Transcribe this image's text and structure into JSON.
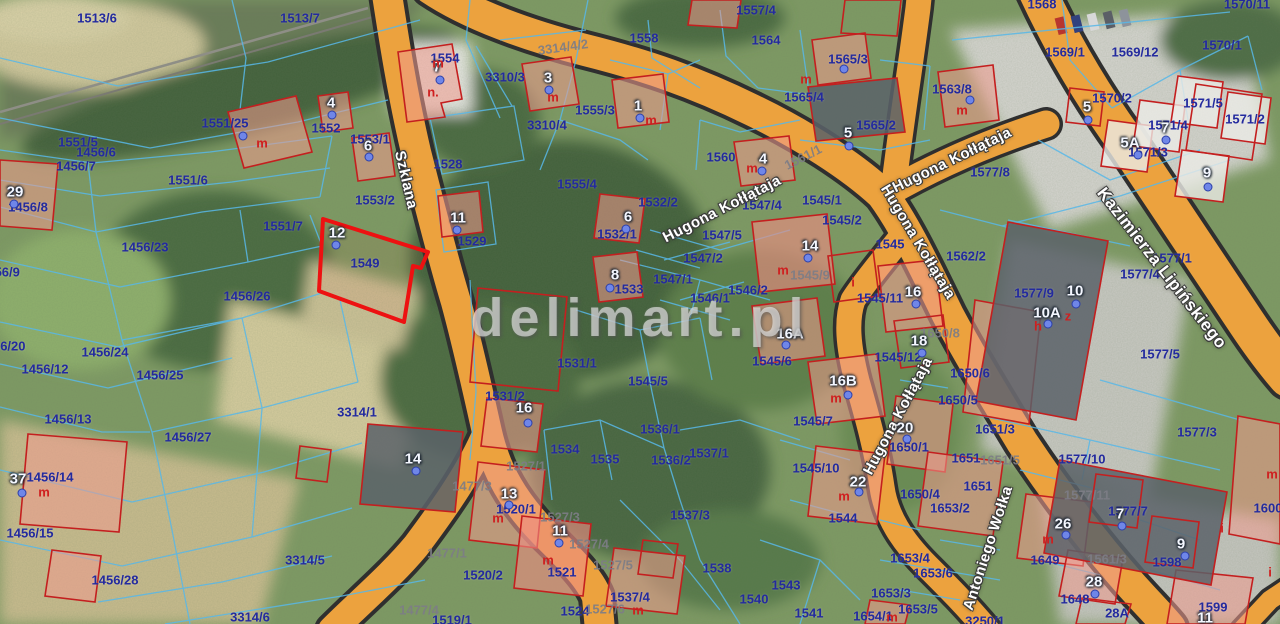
{
  "map": {
    "watermark": "delimart.pl",
    "highlighted_parcel": "1549",
    "accent_colors": {
      "road": "#eca23e",
      "parcel_line": "#58b8e8",
      "building": "#c41f1f",
      "highlight": "#ed1111",
      "label": "#232a9e"
    },
    "streets": [
      {
        "name": "Szklana",
        "x": 406,
        "y": 180,
        "rot": 77,
        "size": 15
      },
      {
        "name": "Hugona Kołłątaja",
        "x": 722,
        "y": 209,
        "rot": -27,
        "size": 15
      },
      {
        "name": "Hugona Kołłątaja",
        "x": 952,
        "y": 160,
        "rot": -26,
        "size": 15
      },
      {
        "name": "Hugona Kołłątaja",
        "x": 918,
        "y": 242,
        "rot": 59,
        "size": 15
      },
      {
        "name": "Hugona Kołłątaja",
        "x": 898,
        "y": 416,
        "rot": -62,
        "size": 15
      },
      {
        "name": "Antoniego Wołka",
        "x": 988,
        "y": 548,
        "rot": -72,
        "size": 15
      },
      {
        "name": "Kazimierza Lipińskiego",
        "x": 1162,
        "y": 268,
        "rot": 52,
        "size": 17
      }
    ],
    "parcel_labels": [
      {
        "t": "1513/6",
        "x": 97,
        "y": 18
      },
      {
        "t": "1513/7",
        "x": 300,
        "y": 18
      },
      {
        "t": "1551/25",
        "x": 225,
        "y": 123
      },
      {
        "t": "1551/5",
        "x": 78,
        "y": 142
      },
      {
        "t": "1456/6",
        "x": 96,
        "y": 152
      },
      {
        "t": "1456/7",
        "x": 76,
        "y": 166
      },
      {
        "t": "1551/6",
        "x": 188,
        "y": 180
      },
      {
        "t": "29",
        "x": 15,
        "y": 192
      },
      {
        "t": "1456/8",
        "x": 28,
        "y": 207
      },
      {
        "t": "1551/7",
        "x": 283,
        "y": 226
      },
      {
        "t": "1456/23",
        "x": 145,
        "y": 247
      },
      {
        "t": "1456/9",
        "x": 0,
        "y": 272
      },
      {
        "t": "1456/26",
        "x": 247,
        "y": 296
      },
      {
        "t": "1456/20",
        "x": 2,
        "y": 346
      },
      {
        "t": "1456/24",
        "x": 105,
        "y": 352
      },
      {
        "t": "1456/12",
        "x": 45,
        "y": 369
      },
      {
        "t": "1456/25",
        "x": 160,
        "y": 375
      },
      {
        "t": "1456/13",
        "x": 68,
        "y": 419
      },
      {
        "t": "1456/27",
        "x": 188,
        "y": 437
      },
      {
        "t": "1456/14",
        "x": 50,
        "y": 477
      },
      {
        "t": "1456/15",
        "x": 30,
        "y": 533
      },
      {
        "t": "1456/28",
        "x": 115,
        "y": 580
      },
      {
        "t": "3314/5",
        "x": 305,
        "y": 560
      },
      {
        "t": "3314/6",
        "x": 250,
        "y": 617
      },
      {
        "t": "3314/1",
        "x": 357,
        "y": 412
      },
      {
        "t": "1549",
        "x": 365,
        "y": 263
      },
      {
        "t": "1553/2",
        "x": 375,
        "y": 200
      },
      {
        "t": "1553/1",
        "x": 370,
        "y": 139
      },
      {
        "t": "1552",
        "x": 326,
        "y": 128
      },
      {
        "t": "1554",
        "x": 445,
        "y": 58
      },
      {
        "t": "1528",
        "x": 448,
        "y": 164
      },
      {
        "t": "1529",
        "x": 472,
        "y": 241
      },
      {
        "t": "3310/3",
        "x": 505,
        "y": 77
      },
      {
        "t": "3310/4",
        "x": 547,
        "y": 125
      },
      {
        "t": "1555/3",
        "x": 595,
        "y": 110
      },
      {
        "t": "1555/4",
        "x": 577,
        "y": 184
      },
      {
        "t": "1558",
        "x": 644,
        "y": 38
      },
      {
        "t": "1557/4",
        "x": 756,
        "y": 10
      },
      {
        "t": "1564",
        "x": 766,
        "y": 40
      },
      {
        "t": "1560",
        "x": 721,
        "y": 157
      },
      {
        "t": "1565/3",
        "x": 848,
        "y": 59
      },
      {
        "t": "1565/4",
        "x": 804,
        "y": 97
      },
      {
        "t": "1565/2",
        "x": 876,
        "y": 125
      },
      {
        "t": "1563/8",
        "x": 952,
        "y": 89
      },
      {
        "t": "1569/1",
        "x": 1065,
        "y": 52
      },
      {
        "t": "1569/12",
        "x": 1135,
        "y": 52
      },
      {
        "t": "1570/1",
        "x": 1222,
        "y": 45
      },
      {
        "t": "1570/2",
        "x": 1112,
        "y": 98
      },
      {
        "t": "1571/5",
        "x": 1203,
        "y": 103
      },
      {
        "t": "1571/2",
        "x": 1245,
        "y": 119
      },
      {
        "t": "1571/4",
        "x": 1168,
        "y": 125
      },
      {
        "t": "1571/3",
        "x": 1148,
        "y": 152
      },
      {
        "t": "1568",
        "x": 1042,
        "y": 4
      },
      {
        "t": "1570/11",
        "x": 1247,
        "y": 4
      },
      {
        "t": "1577/8",
        "x": 990,
        "y": 172
      },
      {
        "t": "1562/2",
        "x": 966,
        "y": 256
      },
      {
        "t": "1577/4",
        "x": 1140,
        "y": 274
      },
      {
        "t": "1577/1",
        "x": 1172,
        "y": 258
      },
      {
        "t": "1577/9",
        "x": 1034,
        "y": 293
      },
      {
        "t": "1577/5",
        "x": 1160,
        "y": 354
      },
      {
        "t": "1532/2",
        "x": 658,
        "y": 202
      },
      {
        "t": "1532/1",
        "x": 617,
        "y": 234
      },
      {
        "t": "1533",
        "x": 629,
        "y": 289
      },
      {
        "t": "1531/1",
        "x": 577,
        "y": 363
      },
      {
        "t": "1531/2",
        "x": 505,
        "y": 396
      },
      {
        "t": "1534",
        "x": 565,
        "y": 449
      },
      {
        "t": "1535",
        "x": 605,
        "y": 459
      },
      {
        "t": "1536/1",
        "x": 660,
        "y": 429
      },
      {
        "t": "1536/2",
        "x": 671,
        "y": 460
      },
      {
        "t": "1537/1",
        "x": 709,
        "y": 453
      },
      {
        "t": "1537/3",
        "x": 690,
        "y": 515
      },
      {
        "t": "1538",
        "x": 717,
        "y": 568
      },
      {
        "t": "1543",
        "x": 786,
        "y": 585
      },
      {
        "t": "1540",
        "x": 754,
        "y": 599
      },
      {
        "t": "1541",
        "x": 809,
        "y": 613
      },
      {
        "t": "1545/7",
        "x": 813,
        "y": 421
      },
      {
        "t": "1545/10",
        "x": 816,
        "y": 468
      },
      {
        "t": "1544",
        "x": 843,
        "y": 518
      },
      {
        "t": "1545/5",
        "x": 648,
        "y": 381
      },
      {
        "t": "1545/6",
        "x": 772,
        "y": 361
      },
      {
        "t": "1545/11",
        "x": 880,
        "y": 298
      },
      {
        "t": "1545/12",
        "x": 898,
        "y": 357
      },
      {
        "t": "1545/1",
        "x": 822,
        "y": 200
      },
      {
        "t": "1545/2",
        "x": 842,
        "y": 220
      },
      {
        "t": "1545",
        "x": 890,
        "y": 244
      },
      {
        "t": "1546/2",
        "x": 748,
        "y": 290
      },
      {
        "t": "1546/1",
        "x": 710,
        "y": 298
      },
      {
        "t": "1547/4",
        "x": 762,
        "y": 205
      },
      {
        "t": "1547/5",
        "x": 722,
        "y": 235
      },
      {
        "t": "1547/2",
        "x": 703,
        "y": 258
      },
      {
        "t": "1547/1",
        "x": 673,
        "y": 279
      },
      {
        "t": "1520/1",
        "x": 516,
        "y": 509
      },
      {
        "t": "1520/2",
        "x": 483,
        "y": 575
      },
      {
        "t": "1521",
        "x": 562,
        "y": 572
      },
      {
        "t": "1524",
        "x": 575,
        "y": 611
      },
      {
        "t": "1537/4",
        "x": 630,
        "y": 597
      },
      {
        "t": "1519/1",
        "x": 452,
        "y": 620
      },
      {
        "t": "1650/1",
        "x": 909,
        "y": 447
      },
      {
        "t": "1650/4",
        "x": 920,
        "y": 494
      },
      {
        "t": "1653/4",
        "x": 910,
        "y": 558
      },
      {
        "t": "1653/6",
        "x": 933,
        "y": 573
      },
      {
        "t": "1653/3",
        "x": 891,
        "y": 593
      },
      {
        "t": "1653/5",
        "x": 918,
        "y": 609
      },
      {
        "t": "1654/1",
        "x": 873,
        "y": 616
      },
      {
        "t": "1653/2",
        "x": 950,
        "y": 508
      },
      {
        "t": "1651/3",
        "x": 995,
        "y": 429
      },
      {
        "t": "1651",
        "x": 966,
        "y": 458
      },
      {
        "t": "1651",
        "x": 978,
        "y": 486
      },
      {
        "t": "1650/6",
        "x": 970,
        "y": 373
      },
      {
        "t": "1650/5",
        "x": 958,
        "y": 400
      },
      {
        "t": "1577/10",
        "x": 1082,
        "y": 459
      },
      {
        "t": "1577/3",
        "x": 1197,
        "y": 432
      },
      {
        "t": "1577/7",
        "x": 1128,
        "y": 511
      },
      {
        "t": "1649",
        "x": 1045,
        "y": 560
      },
      {
        "t": "1598",
        "x": 1167,
        "y": 562
      },
      {
        "t": "1648",
        "x": 1075,
        "y": 599
      },
      {
        "t": "28A",
        "x": 1117,
        "y": 613
      },
      {
        "t": "1599",
        "x": 1213,
        "y": 607
      },
      {
        "t": "1600",
        "x": 1268,
        "y": 508
      },
      {
        "t": "3250/1",
        "x": 985,
        "y": 621
      }
    ],
    "road_parcel_labels": [
      {
        "t": "3314/4/2",
        "x": 563,
        "y": 47,
        "rot": -8
      },
      {
        "t": "1561/1",
        "x": 803,
        "y": 157,
        "rot": -27
      },
      {
        "t": "1477/3",
        "x": 472,
        "y": 486,
        "rot": 0
      },
      {
        "t": "1477/1",
        "x": 447,
        "y": 553,
        "rot": 0
      },
      {
        "t": "1477/4",
        "x": 419,
        "y": 610,
        "rot": 0
      },
      {
        "t": "1527/1",
        "x": 526,
        "y": 466,
        "rot": 0
      },
      {
        "t": "1527/3",
        "x": 560,
        "y": 517,
        "rot": 0
      },
      {
        "t": "1527/4",
        "x": 589,
        "y": 544,
        "rot": 0
      },
      {
        "t": "1527/5",
        "x": 613,
        "y": 565,
        "rot": 0
      },
      {
        "t": "1527/6",
        "x": 605,
        "y": 609,
        "rot": 0
      },
      {
        "t": "1545/9",
        "x": 810,
        "y": 275,
        "rot": 0
      },
      {
        "t": "1650/8",
        "x": 940,
        "y": 333,
        "rot": 0
      },
      {
        "t": "1561/3",
        "x": 1107,
        "y": 559,
        "rot": 0
      },
      {
        "t": "1577/11",
        "x": 1087,
        "y": 495,
        "rot": 0
      },
      {
        "t": "1651/5",
        "x": 1000,
        "y": 460,
        "rot": 0
      }
    ],
    "building_numbers": [
      {
        "n": "7",
        "x": 437,
        "y": 67,
        "dx": 440,
        "dy": 80
      },
      {
        "n": "4",
        "x": 331,
        "y": 103,
        "dx": 332,
        "dy": 115
      },
      {
        "n": "6",
        "x": 368,
        "y": 146,
        "dx": 369,
        "dy": 157
      },
      {
        "n": "3",
        "x": 548,
        "y": 78,
        "dx": 549,
        "dy": 90
      },
      {
        "n": "1",
        "x": 638,
        "y": 106,
        "dx": 640,
        "dy": 118
      },
      {
        "n": "11",
        "x": 458,
        "y": 218,
        "dx": 457,
        "dy": 230
      },
      {
        "n": "12",
        "x": 337,
        "y": 233,
        "dx": 336,
        "dy": 245
      },
      {
        "n": "8",
        "x": 615,
        "y": 275,
        "dx": 610,
        "dy": 288
      },
      {
        "n": "6",
        "x": 628,
        "y": 217,
        "dx": 626,
        "dy": 229
      },
      {
        "n": "4",
        "x": 763,
        "y": 159,
        "dx": 762,
        "dy": 171
      },
      {
        "n": "5",
        "x": 848,
        "y": 133,
        "dx": 849,
        "dy": 146
      },
      {
        "n": "29",
        "x": 15,
        "y": 192,
        "dx": 14,
        "dy": 204
      },
      {
        "n": "37",
        "x": 18,
        "y": 479,
        "dx": 22,
        "dy": 493
      },
      {
        "n": "13",
        "x": 509,
        "y": 494,
        "dx": 509,
        "dy": 505
      },
      {
        "n": "14",
        "x": 413,
        "y": 459,
        "dx": 416,
        "dy": 471
      },
      {
        "n": "16",
        "x": 524,
        "y": 408,
        "dx": 528,
        "dy": 423
      },
      {
        "n": "11",
        "x": 560,
        "y": 531,
        "dx": 559,
        "dy": 543
      },
      {
        "n": "14",
        "x": 810,
        "y": 246,
        "dx": 808,
        "dy": 258
      },
      {
        "n": "16",
        "x": 913,
        "y": 292,
        "dx": 916,
        "dy": 304
      },
      {
        "n": "18",
        "x": 919,
        "y": 341,
        "dx": 922,
        "dy": 353
      },
      {
        "n": "16A",
        "x": 790,
        "y": 334,
        "dx": 786,
        "dy": 345
      },
      {
        "n": "16B",
        "x": 843,
        "y": 381,
        "dx": 848,
        "dy": 395
      },
      {
        "n": "22",
        "x": 858,
        "y": 482,
        "dx": 859,
        "dy": 492
      },
      {
        "n": "20",
        "x": 905,
        "y": 428,
        "dx": 907,
        "dy": 439
      },
      {
        "n": "5",
        "x": 1087,
        "y": 107,
        "dx": 1088,
        "dy": 120
      },
      {
        "n": "5A",
        "x": 1130,
        "y": 143,
        "dx": 1138,
        "dy": 155
      },
      {
        "n": "7",
        "x": 1165,
        "y": 128,
        "dx": 1166,
        "dy": 140
      },
      {
        "n": "9",
        "x": 1207,
        "y": 173,
        "dx": 1208,
        "dy": 187
      },
      {
        "n": "10",
        "x": 1075,
        "y": 291,
        "dx": 1076,
        "dy": 304
      },
      {
        "n": "10A",
        "x": 1047,
        "y": 313,
        "dx": 1048,
        "dy": 324
      },
      {
        "n": "26",
        "x": 1063,
        "y": 524,
        "dx": 1066,
        "dy": 535
      },
      {
        "n": "7",
        "x": 1120,
        "y": 514,
        "dx": 1122,
        "dy": 526
      },
      {
        "n": "9",
        "x": 1181,
        "y": 544,
        "dx": 1185,
        "dy": 556
      },
      {
        "n": "28",
        "x": 1094,
        "y": 582,
        "dx": 1095,
        "dy": 594
      },
      {
        "n": "11",
        "x": 1205,
        "y": 618,
        "dx": null,
        "dy": null
      }
    ],
    "extra_dots": [
      {
        "x": 243,
        "y": 136
      },
      {
        "x": 970,
        "y": 100
      },
      {
        "x": 844,
        "y": 69
      }
    ],
    "building_type_markers": [
      {
        "t": "m",
        "x": 262,
        "y": 143
      },
      {
        "t": "n.",
        "x": 433,
        "y": 92
      },
      {
        "t": "m",
        "x": 438,
        "y": 63
      },
      {
        "t": "m",
        "x": 553,
        "y": 97
      },
      {
        "t": "m",
        "x": 806,
        "y": 79
      },
      {
        "t": "m",
        "x": 962,
        "y": 110
      },
      {
        "t": "m",
        "x": 651,
        "y": 120
      },
      {
        "t": "m",
        "x": 752,
        "y": 168
      },
      {
        "t": "m",
        "x": 783,
        "y": 270
      },
      {
        "t": "i",
        "x": 853,
        "y": 282
      },
      {
        "t": "m",
        "x": 44,
        "y": 492
      },
      {
        "t": "m",
        "x": 498,
        "y": 518
      },
      {
        "t": "m",
        "x": 548,
        "y": 560
      },
      {
        "t": "m",
        "x": 638,
        "y": 610
      },
      {
        "t": "m",
        "x": 836,
        "y": 398
      },
      {
        "t": "m",
        "x": 844,
        "y": 496
      },
      {
        "t": "h",
        "x": 1038,
        "y": 326
      },
      {
        "t": "z",
        "x": 1068,
        "y": 316
      },
      {
        "t": "m",
        "x": 1048,
        "y": 539
      },
      {
        "t": "i",
        "x": 1222,
        "y": 528
      },
      {
        "t": "i",
        "x": 1270,
        "y": 572
      },
      {
        "t": "m",
        "x": 1272,
        "y": 474
      },
      {
        "t": "m",
        "x": 892,
        "y": 617
      }
    ]
  }
}
